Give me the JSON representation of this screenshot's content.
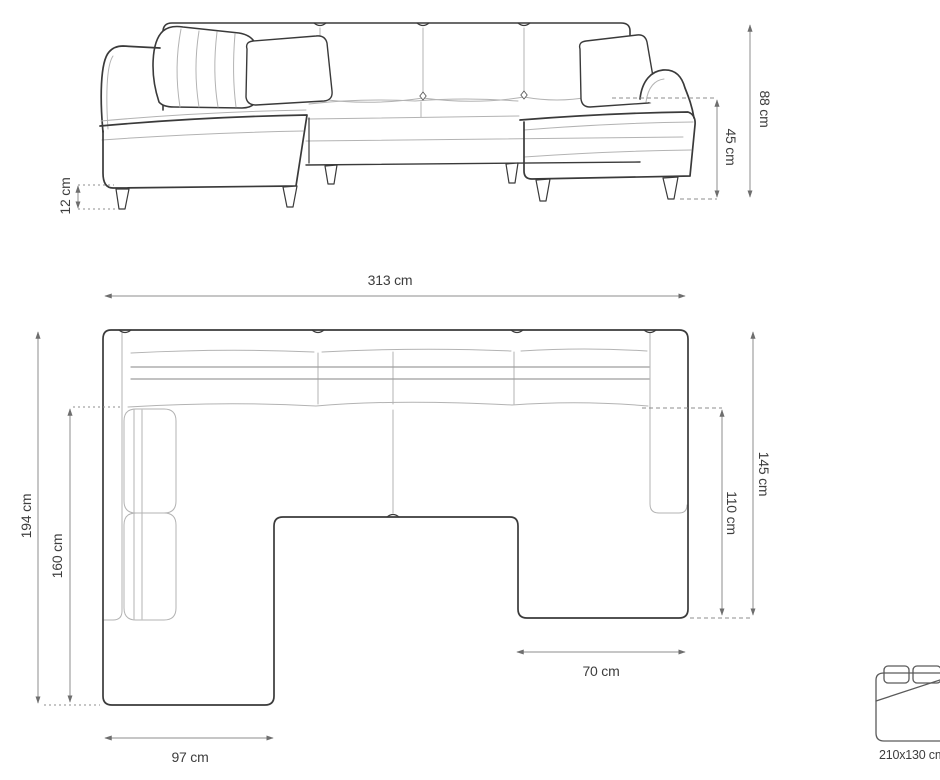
{
  "front_view": {
    "name": "front-elevation-view",
    "dimensions": {
      "leg_height": "12 cm",
      "seat_height": "45 cm",
      "overall_height": "88 cm"
    }
  },
  "top_view": {
    "name": "top-plan-view",
    "dimensions": {
      "overall_width": "313 cm",
      "left_side_depth": "194 cm",
      "left_inner_depth": "160 cm",
      "right_side_depth": "145 cm",
      "right_inner_depth": "110 cm",
      "right_chaise_width": "70 cm",
      "left_chaise_width": "97 cm"
    }
  },
  "sleeping_function": {
    "icon": "sofa-bed-icon",
    "size_label": "210x130 cm"
  },
  "colors": {
    "outline": "#3a3a3a",
    "seam": "#b3b3b3",
    "dimension_line": "#8c8c8c",
    "text": "#3d3d3d",
    "background": "#ffffff"
  }
}
